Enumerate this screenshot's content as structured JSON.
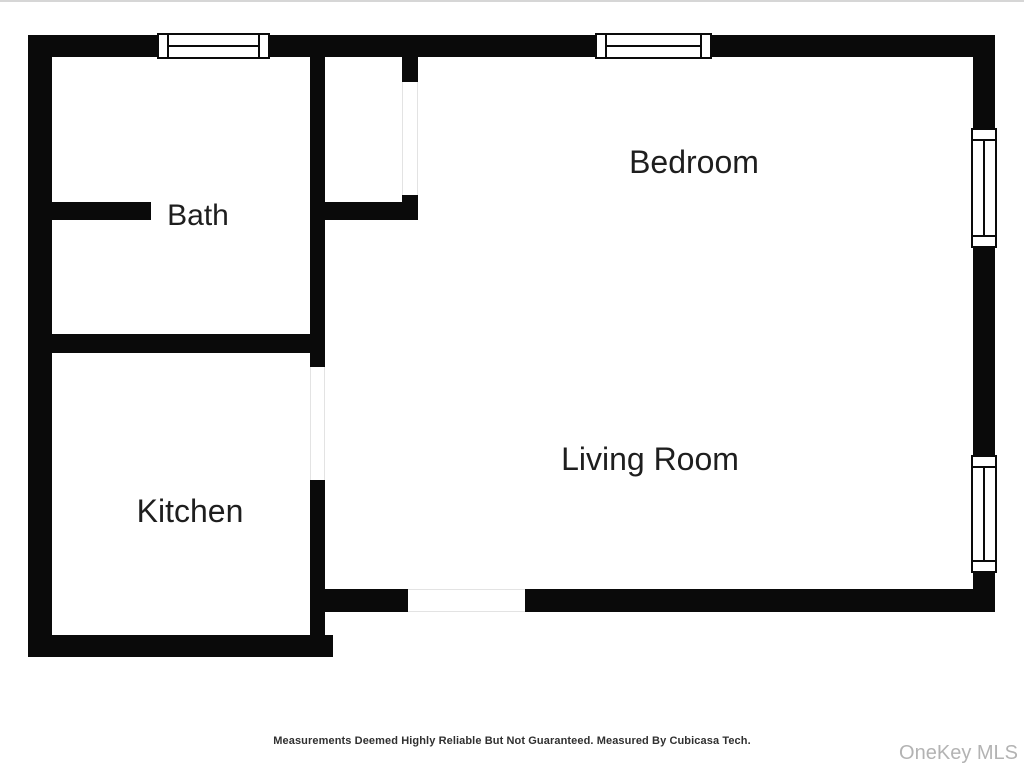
{
  "floorplan": {
    "rooms": [
      {
        "label": "Bath"
      },
      {
        "label": "Kitchen"
      },
      {
        "label": "Bedroom"
      },
      {
        "label": "Living Room"
      }
    ],
    "disclaimer": "Measurements Deemed Highly Reliable But Not Guaranteed. Measured By Cubicasa Tech.",
    "watermark": "OneKey MLS",
    "colors": {
      "wall": "#0a0a0a",
      "background": "#ffffff",
      "label_text": "#1e1e1e",
      "disclaimer_text": "#303030",
      "watermark_text": "#b3b3b3",
      "door_gap_line": "#e3e3e3"
    }
  }
}
